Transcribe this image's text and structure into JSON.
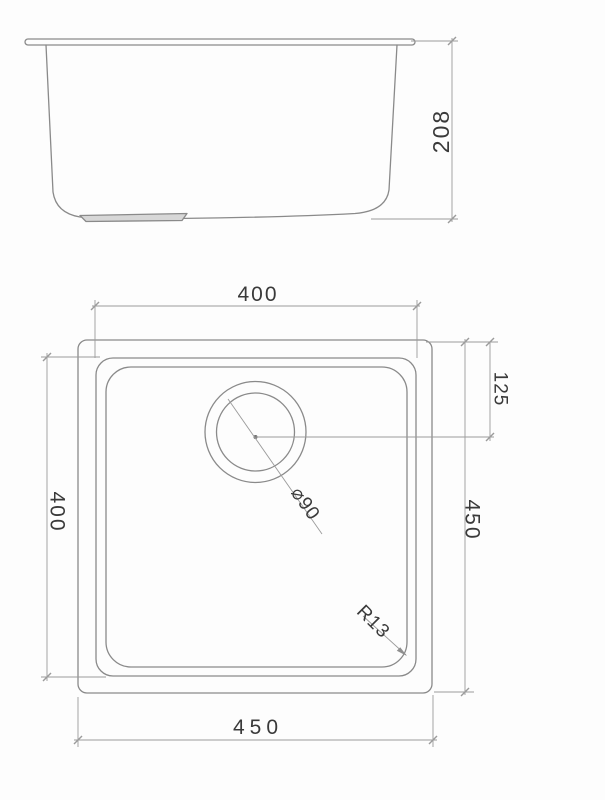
{
  "views": {
    "side_elevation": {
      "depth_dim": "208"
    },
    "plan": {
      "inner_bowl_width_dim": "400",
      "inner_bowl_length_dim": "400",
      "overall_length_dim": "450",
      "overall_width_dim": "450",
      "drain_center_offset_dim": "125",
      "drain_diameter_dim": "⌀90",
      "corner_radius_dim": "R13"
    }
  },
  "colors": {
    "object_line": "#8a8a8a",
    "dimension_line": "#9b9b9b",
    "dim_text": "#3a3a3a",
    "background": "#fdfdfd"
  }
}
